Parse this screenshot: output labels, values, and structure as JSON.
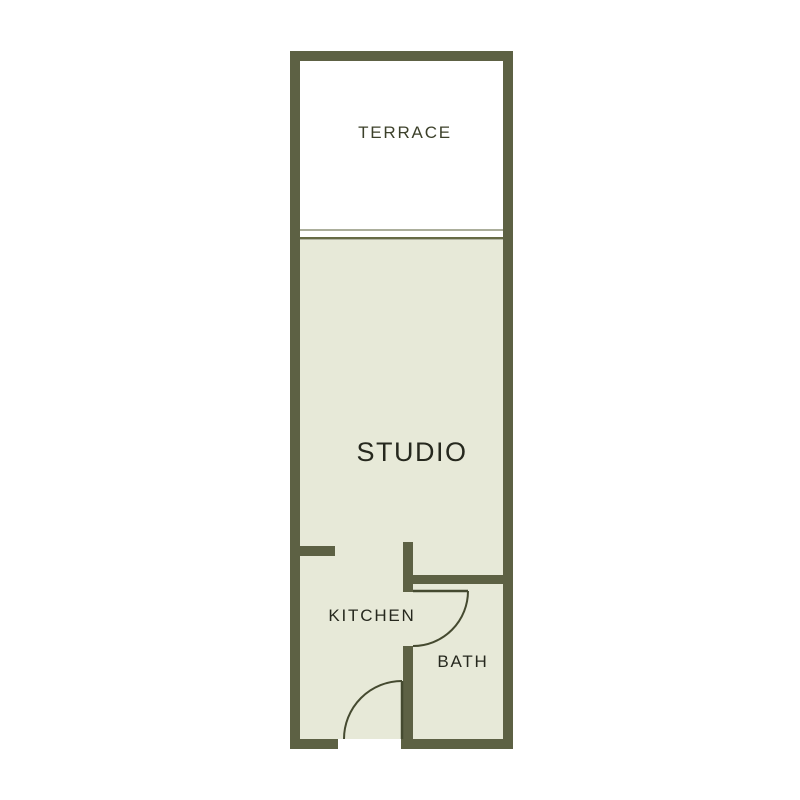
{
  "floorplan": {
    "title": "Studio apartment floor plan",
    "rooms": [
      {
        "id": "terrace",
        "label": "TERRACE"
      },
      {
        "id": "studio",
        "label": "STUDIO"
      },
      {
        "id": "kitchen",
        "label": "KITCHEN"
      },
      {
        "id": "bath",
        "label": "BATH"
      }
    ],
    "colors": {
      "background": "#ffffff",
      "wall": "#5d6144",
      "floor": "#e7e9d8",
      "terrace_floor": "#ffffff",
      "divider_light": "#abae9b",
      "divider_dark": "#666a45",
      "door_line": "#454a30",
      "label_olive": "#3c402a",
      "label_dark": "#26281e"
    }
  }
}
